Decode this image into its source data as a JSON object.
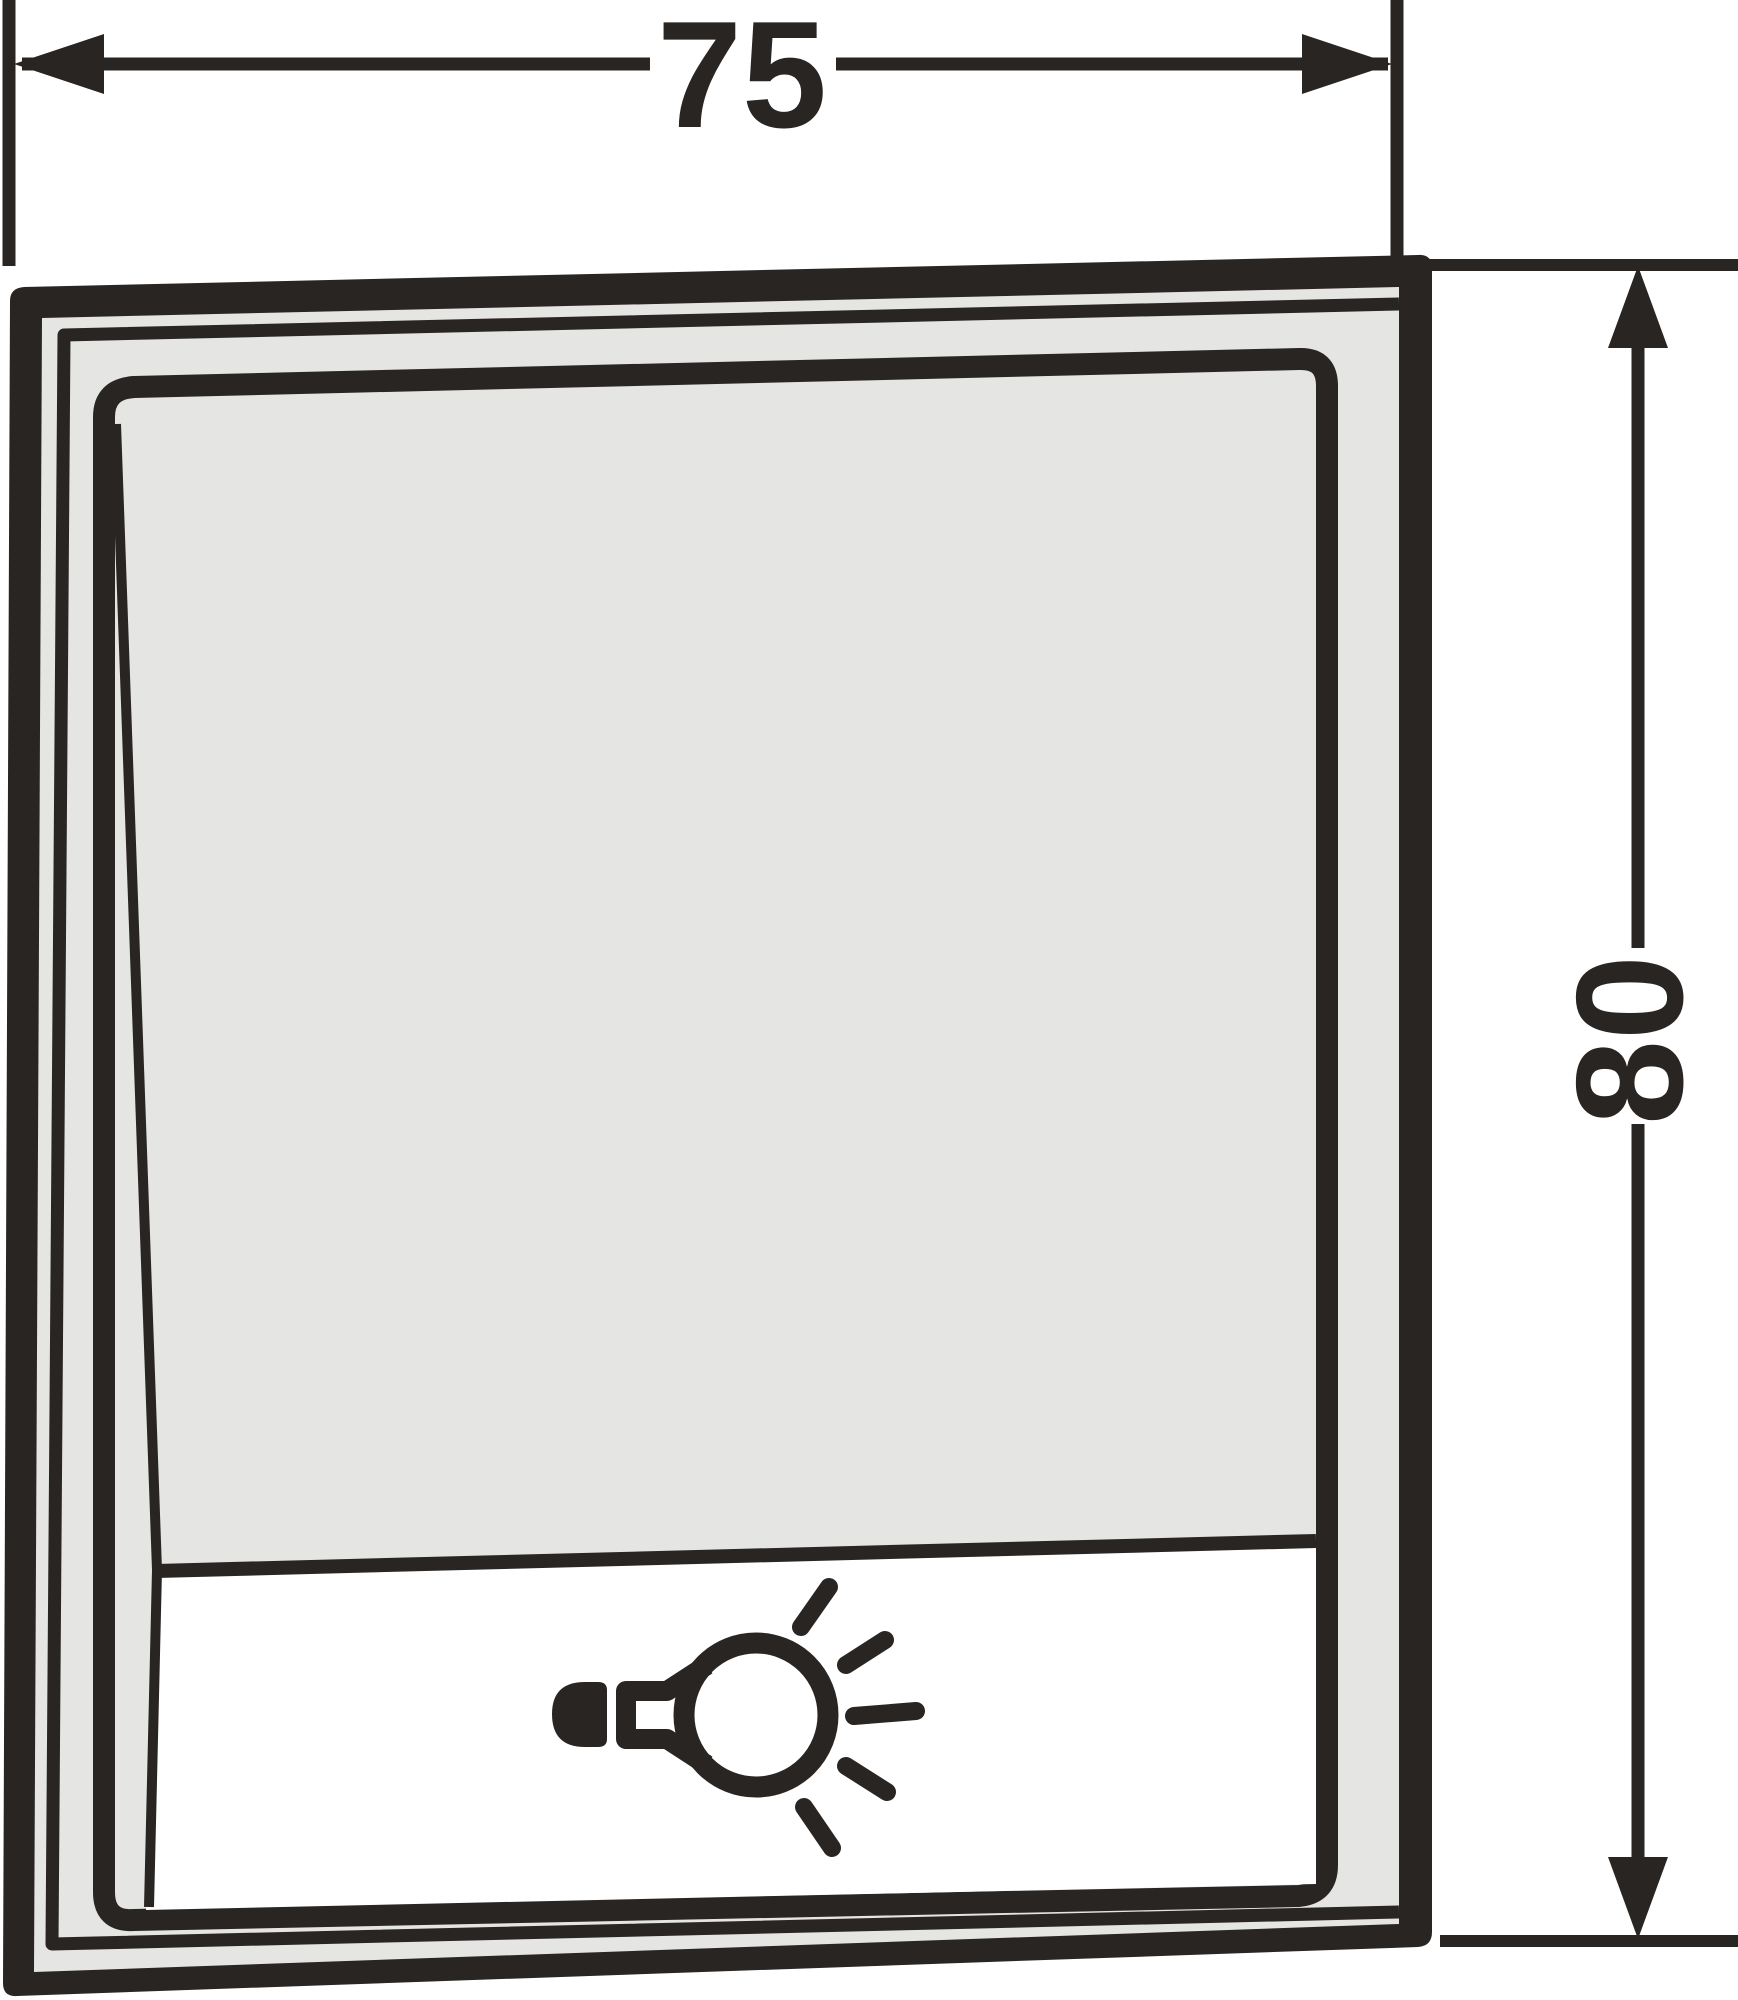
{
  "drawing": {
    "title": "light-switch-dimension-drawing",
    "width_dim": {
      "value": "75"
    },
    "height_dim": {
      "value": "80"
    },
    "symbol": "light-bulb-icon",
    "colors": {
      "ink": "#282522",
      "panel_gray": "#e5e5e4",
      "label_white": "#ffffff",
      "paper": "#ffffff"
    }
  }
}
